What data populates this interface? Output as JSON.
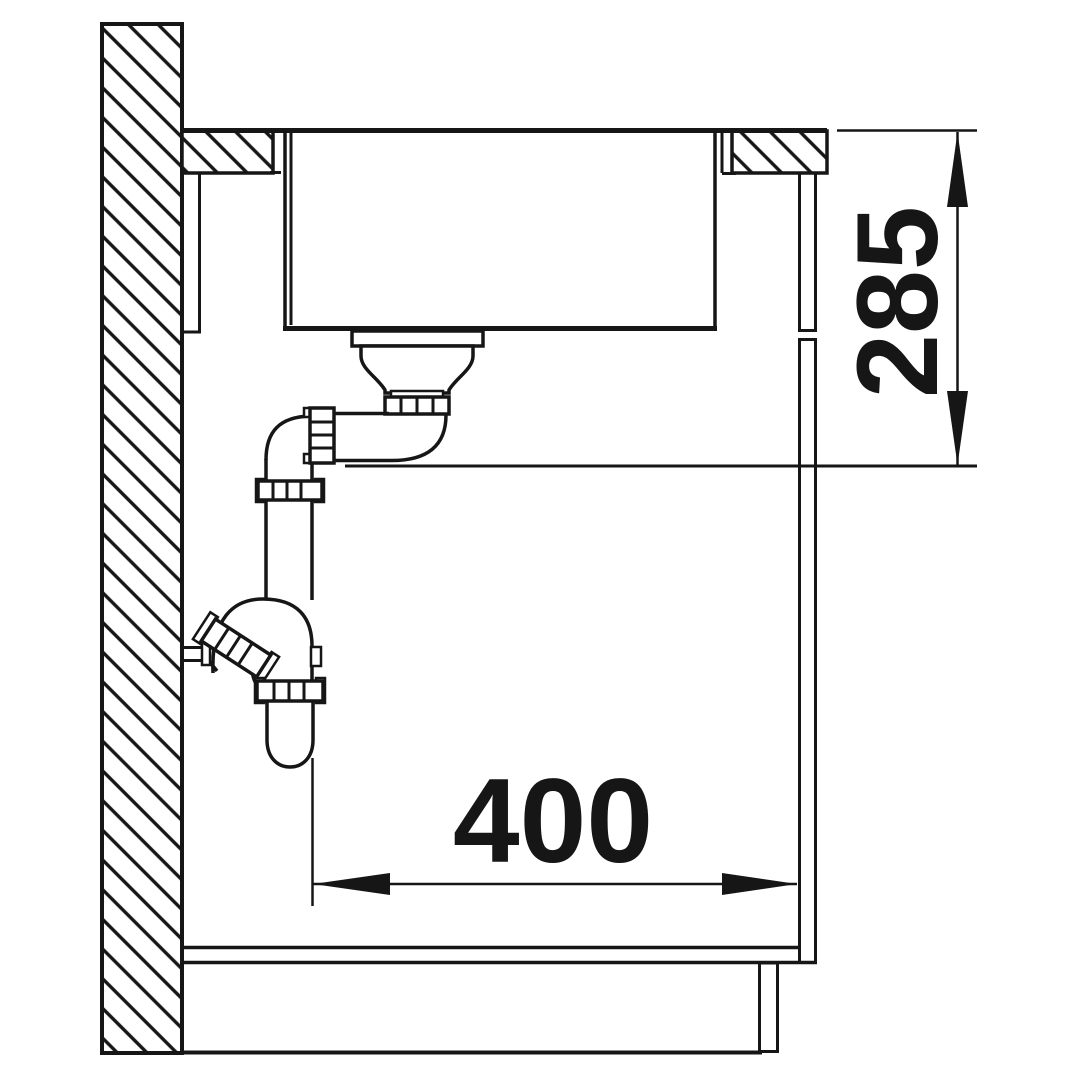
{
  "drawing": {
    "type": "sink-installation-cross-section",
    "line_color": "#161616",
    "background_color": "#ffffff",
    "dimensions": {
      "vertical": {
        "value": "285"
      },
      "horizontal": {
        "value": "400"
      }
    }
  }
}
